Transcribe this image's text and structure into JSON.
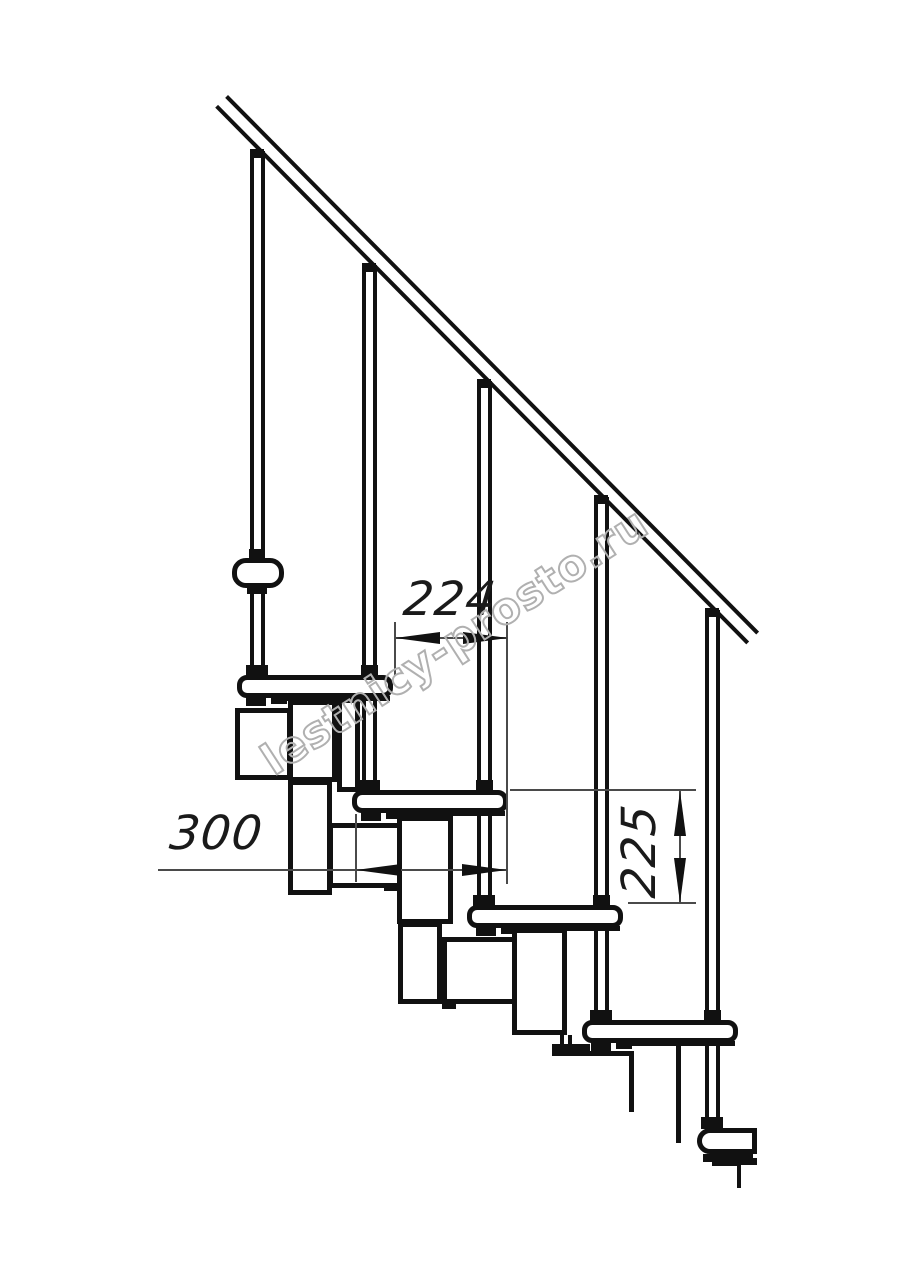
{
  "page": {
    "background": "#ffffff",
    "line_color": "#111111",
    "thin_line_color": "#4a4a4a",
    "watermark_color": "#b0b0b0"
  },
  "drawing": {
    "title": "modular-staircase-side-view",
    "dimension_labels": {
      "going": "224",
      "tread_depth": "300",
      "rise": "225"
    }
  },
  "watermark": {
    "text": "lestnicy-prosto.ru"
  }
}
